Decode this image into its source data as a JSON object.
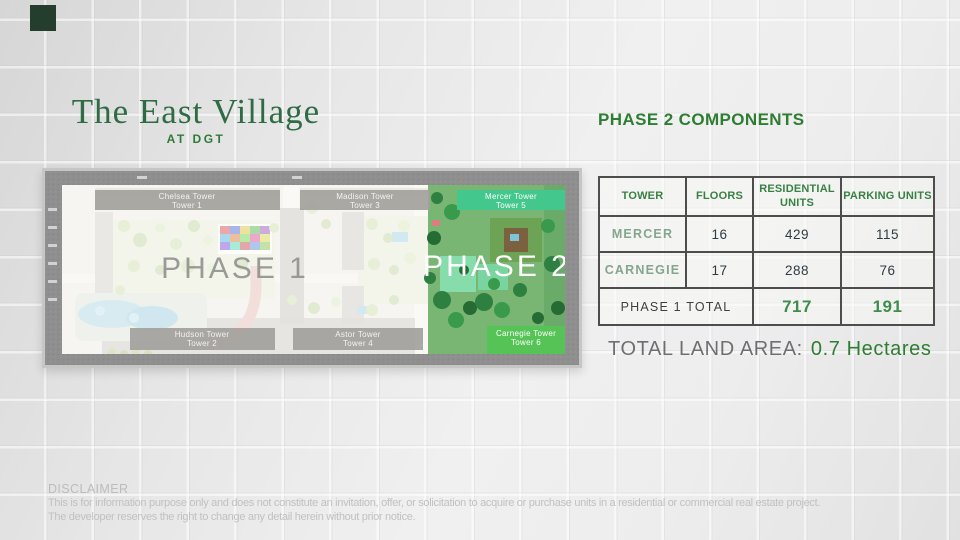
{
  "brand": {
    "title": "The East Village",
    "subtitle": "AT DGT"
  },
  "site_plan": {
    "phase1_label": "PHASE 1",
    "phase2_label": "PHASE 2",
    "towers": [
      {
        "name": "Chelsea Tower",
        "number": "Tower 1",
        "phase": 1
      },
      {
        "name": "Madison Tower",
        "number": "Tower 3",
        "phase": 1
      },
      {
        "name": "Mercer Tower",
        "number": "Tower 5",
        "phase": 2
      },
      {
        "name": "Hudson Tower",
        "number": "Tower 2",
        "phase": 1
      },
      {
        "name": "Astor Tower",
        "number": "Tower 4",
        "phase": 1
      },
      {
        "name": "Carnegie Tower",
        "number": "Tower 6",
        "phase": 2
      }
    ]
  },
  "components": {
    "heading": "PHASE 2 COMPONENTS",
    "table": {
      "headers": [
        "TOWER",
        "FLOORS",
        "RESIDENTIAL UNITS",
        "PARKING UNITS"
      ],
      "rows": [
        {
          "tower": "MERCER",
          "floors": "16",
          "residential": "429",
          "parking": "115"
        },
        {
          "tower": "CARNEGIE",
          "floors": "17",
          "residential": "288",
          "parking": "76"
        }
      ],
      "total": {
        "label": "PHASE 1 TOTAL",
        "residential": "717",
        "parking": "191"
      }
    }
  },
  "land_area": {
    "label": "TOTAL LAND AREA:",
    "value": "0.7 Hectares"
  },
  "disclaimer": {
    "heading": "DISCLAIMER",
    "line1": "This is for information purpose only and does not constitute an invitation, offer, or solicitation to acquire or purchase units in a residential or commercial real estate project.",
    "line2": "The developer reserves the right to change any detail herein without prior notice."
  },
  "colors": {
    "accent_green": "#2e7d33",
    "title_green": "#2f6b44",
    "muted_green": "#84a58e",
    "text_gray": "#6e6f72",
    "disclaimer_gray": "#c1c1c1",
    "phase2_green": "#79b573",
    "corner_square": "#243d2d"
  }
}
